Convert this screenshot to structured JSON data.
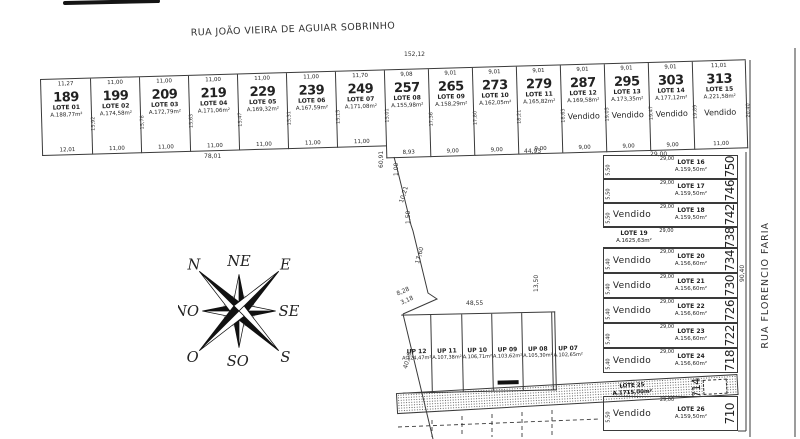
{
  "streets": {
    "top": "RUA JOÃO VIEIRA DE AGUIAR SOBRINHO",
    "right": "RUA FLORENCIO FARIA"
  },
  "sold_label": "Vendido",
  "top_row_lots": [
    {
      "number": "189",
      "lote": "LOTE 01",
      "area": "A.188,77m²",
      "top_dim": "11,27",
      "bottom_dim": "12,01",
      "side_dim": "15,92",
      "sold": false
    },
    {
      "number": "199",
      "lote": "LOTE 02",
      "area": "A.174,58m²",
      "top_dim": "11,00",
      "bottom_dim": "11,00",
      "side_dim": "15,78",
      "sold": false
    },
    {
      "number": "209",
      "lote": "LOTE 03",
      "area": "A.172,79m²",
      "top_dim": "11,00",
      "bottom_dim": "11,00",
      "side_dim": "15,63",
      "sold": false
    },
    {
      "number": "219",
      "lote": "LOTE 04",
      "area": "A.171,06m²",
      "top_dim": "11,00",
      "bottom_dim": "11,00",
      "side_dim": "15,47",
      "sold": false
    },
    {
      "number": "229",
      "lote": "LOTE 05",
      "area": "A.169,32m²",
      "top_dim": "11,00",
      "bottom_dim": "11,00",
      "side_dim": "15,31",
      "sold": false
    },
    {
      "number": "239",
      "lote": "LOTE 06",
      "area": "A.167,59m²",
      "top_dim": "11,00",
      "bottom_dim": "11,00",
      "side_dim": "15,15",
      "sold": false
    },
    {
      "number": "249",
      "lote": "LOTE 07",
      "area": "A.171,08m²",
      "top_dim": "11,70",
      "bottom_dim": "11,00",
      "side_dim": "15,01",
      "sold": false
    },
    {
      "number": "257",
      "lote": "LOTE 08",
      "area": "A.155,98m²",
      "top_dim": "9,08",
      "bottom_dim": "8,93",
      "side_dim": "17,36",
      "sold": false
    },
    {
      "number": "265",
      "lote": "LOTE 09",
      "area": "A.158,29m²",
      "top_dim": "9,01",
      "bottom_dim": "9,00",
      "side_dim": "17,80",
      "sold": false
    },
    {
      "number": "273",
      "lote": "LOTE 10",
      "area": "A.162,05m²",
      "top_dim": "9,01",
      "bottom_dim": "9,00",
      "side_dim": "18,21",
      "sold": false
    },
    {
      "number": "279",
      "lote": "LOTE 11",
      "area": "A.165,82m²",
      "top_dim": "9,01",
      "bottom_dim": "9,00",
      "side_dim": "18,63",
      "sold": false
    },
    {
      "number": "287",
      "lote": "LOTE 12",
      "area": "A.169,58m²",
      "top_dim": "9,01",
      "bottom_dim": "9,00",
      "side_dim": "19,05",
      "sold": true
    },
    {
      "number": "295",
      "lote": "LOTE 13",
      "area": "A.173,35m²",
      "top_dim": "9,01",
      "bottom_dim": "9,00",
      "side_dim": "19,47",
      "sold": true
    },
    {
      "number": "303",
      "lote": "LOTE 14",
      "area": "A.177,12m²",
      "top_dim": "9,01",
      "bottom_dim": "9,00",
      "side_dim": "19,89",
      "sold": true
    },
    {
      "number": "313",
      "lote": "LOTE 15",
      "area": "A.221,58m²",
      "top_dim": "11,01",
      "bottom_dim": "11,00",
      "side_dim": "20,40",
      "sold": true
    }
  ],
  "right_block_rows": [
    {
      "lote": "LOTE 16",
      "area": "A.159,50m²",
      "number": "750",
      "width_dim": "29,00",
      "side_dim": "5,50",
      "sold": false
    },
    {
      "lote": "LOTE 17",
      "area": "A.159,50m²",
      "number": "746",
      "width_dim": "29,00",
      "side_dim": "5,50",
      "sold": false
    },
    {
      "lote": "LOTE 18",
      "area": "A.159,50m²",
      "number": "742",
      "width_dim": "29,00",
      "side_dim": "5,50",
      "sold": true
    },
    {
      "lote": "LOTE 19",
      "area": "A.1625,63m²",
      "number": "738",
      "width_dim": "29,00",
      "side_dim": "6,00",
      "sold": false
    },
    {
      "lote": "LOTE 20",
      "area": "A.156,60m²",
      "number": "734",
      "width_dim": "29,00",
      "side_dim": "5,40",
      "sold": true
    },
    {
      "lote": "LOTE 21",
      "area": "A.156,60m²",
      "number": "730",
      "width_dim": "29,00",
      "side_dim": "5,40",
      "sold": true
    },
    {
      "lote": "LOTE 22",
      "area": "A.156,60m²",
      "number": "726",
      "width_dim": "29,00",
      "side_dim": "5,40",
      "sold": true
    },
    {
      "lote": "LOTE 23",
      "area": "A.156,60m²",
      "number": "722",
      "width_dim": "29,00",
      "side_dim": "5,40",
      "sold": false
    },
    {
      "lote": "LOTE 24",
      "area": "A.156,60m²",
      "number": "718",
      "width_dim": "29,00",
      "side_dim": "5,40",
      "sold": true
    },
    {
      "lote": "LOTE 25",
      "area": "A.1715,00m²",
      "number": "714",
      "width_dim": "",
      "side_dim": "",
      "sold": false
    },
    {
      "lote": "LOTE 26",
      "area": "A.159,50m²",
      "number": "710",
      "width_dim": "29,00",
      "side_dim": "5,50",
      "sold": true
    }
  ],
  "up_block": {
    "lots": [
      {
        "name": "UP 12",
        "area": "A.124,47m²"
      },
      {
        "name": "UP 11",
        "area": "A.107,38m²"
      },
      {
        "name": "UP 10",
        "area": "A.106,71m²"
      },
      {
        "name": "UP 09",
        "area": "A.103,62m²"
      },
      {
        "name": "UP 08",
        "area": "A.105,30m²"
      },
      {
        "name": "UP 07",
        "area": "A.102,65m²"
      }
    ]
  },
  "compass": {
    "n": "N",
    "ne": "NE",
    "e": "E",
    "se": "SE",
    "s": "S",
    "so": "SO",
    "o": "O",
    "no": "NO"
  },
  "misc_dims": [
    {
      "id": "d152",
      "text": "152,12"
    },
    {
      "id": "d78",
      "text": "78,01"
    },
    {
      "id": "d4493",
      "text": "44,93"
    },
    {
      "id": "d2900",
      "text": "29,00"
    },
    {
      "id": "d6091",
      "text": "60,91"
    },
    {
      "id": "d100",
      "text": "1,00"
    },
    {
      "id": "d1021",
      "text": "10,21"
    },
    {
      "id": "d150",
      "text": "1,50"
    },
    {
      "id": "d1760",
      "text": "17,60"
    },
    {
      "id": "d828",
      "text": "8,28"
    },
    {
      "id": "d318",
      "text": "3,18"
    },
    {
      "id": "d4855",
      "text": "48,55"
    },
    {
      "id": "d4006",
      "text": "40,06"
    },
    {
      "id": "d1350",
      "text": "13,50"
    },
    {
      "id": "d9040",
      "text": "90,40"
    }
  ]
}
